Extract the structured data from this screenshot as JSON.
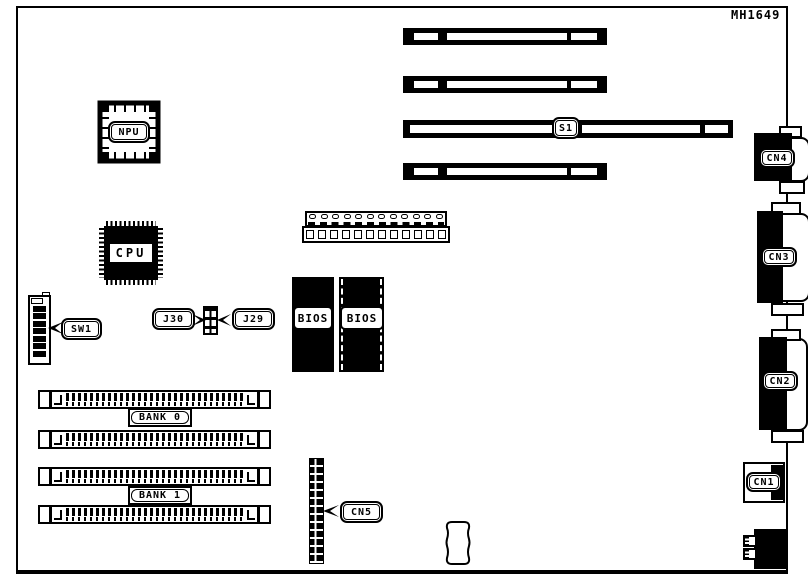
{
  "board": {
    "part_number": "MH1649",
    "labels": {
      "npu": "NPU",
      "cpu": "CPU",
      "bios": "BIOS",
      "s1": "S1",
      "sw1": "SW1",
      "j30": "J30",
      "j29": "J29",
      "bank0": "BANK 0",
      "bank1": "BANK 1",
      "cn5": "CN5",
      "cn4": "CN4",
      "cn3": "CN3",
      "cn2": "CN2",
      "cn1": "CN1"
    },
    "colors": {
      "ink": "#000000",
      "paper": "#ffffff"
    }
  }
}
